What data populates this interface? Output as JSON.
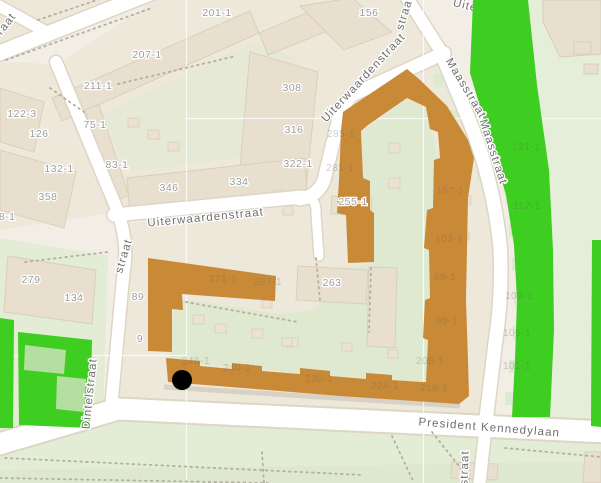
{
  "map": {
    "marker": {
      "x": 182,
      "y": 380,
      "r": 10
    },
    "colors": {
      "base": "#f2eee5",
      "block": "#eee8db",
      "building": "#e8dfce",
      "buildingStroke": "#d8cdb9",
      "road": "#ffffff",
      "casing": "#ddd6c5",
      "parkLight": "#e3ecd4",
      "lawn": "#e4eed8",
      "courtyard": "#dee9d0",
      "highlight": "#c98a38",
      "parcel": "#3ecd21",
      "parcelInner": "#b5dfa2",
      "shed": "#ebe2d1",
      "gardenSquare": "#dcead0",
      "dots": "#b3afa1",
      "houseLabel": "#9c9c9c",
      "streetLabel": "#6e6e6e",
      "ghostLabel": "rgba(100,95,85,0.30)",
      "marker": "#000000",
      "seam": "rgba(255,255,255,0.75)"
    },
    "street_labels": [
      {
        "text": "Uiterwaardenstraat",
        "x": 206,
        "y": 221,
        "rot": -5.5,
        "fs": 12,
        "ls": 1.6
      },
      {
        "text": "Uiterwaardenstraat",
        "x": 366,
        "y": 80,
        "rot": -47,
        "fs": 11,
        "ls": 0.2
      },
      {
        "text": "straat",
        "x": 408,
        "y": 14,
        "rot": -73,
        "fs": 11.5,
        "ls": 1
      },
      {
        "text": "Maasstraat",
        "x": 463,
        "y": 90,
        "rot": 59,
        "fs": 11.5,
        "ls": 1.2
      },
      {
        "text": "Maasstraat",
        "x": 490,
        "y": 153,
        "rot": 72,
        "fs": 11.5,
        "ls": 1.2
      },
      {
        "text": "Dintelstraat",
        "x": 93,
        "y": 394,
        "rot": -84,
        "fs": 11.5,
        "ls": 1.2
      },
      {
        "text": "straat",
        "x": 127,
        "y": 257,
        "rot": -73,
        "fs": 11.5,
        "ls": 1.2
      },
      {
        "text": "President Kennedylaan",
        "x": 489,
        "y": 431,
        "rot": 4.5,
        "fs": 11.5,
        "ls": 0.6
      },
      {
        "text": "straat",
        "x": 468,
        "y": 468,
        "rot": -88,
        "fs": 11.5,
        "ls": 1
      },
      {
        "text": "raat",
        "x": 9,
        "y": 26,
        "rot": -52,
        "fs": 11.5,
        "ls": 1
      }
    ],
    "street_labels_under_overlay": [
      {
        "text": "Uiterwaar",
        "x": 481,
        "y": 13,
        "rot": 14,
        "fs": 11.5,
        "ls": 1
      }
    ],
    "house_numbers": [
      {
        "text": "201-1",
        "x": 217,
        "y": 16
      },
      {
        "text": "156",
        "x": 369,
        "y": 16
      },
      {
        "text": "207-1",
        "x": 147,
        "y": 58
      },
      {
        "text": "211-1",
        "x": 98,
        "y": 89
      },
      {
        "text": "308",
        "x": 292,
        "y": 91
      },
      {
        "text": "122-3",
        "x": 22,
        "y": 117
      },
      {
        "text": "75-1",
        "x": 95,
        "y": 128
      },
      {
        "text": "126",
        "x": 39,
        "y": 137
      },
      {
        "text": "316",
        "x": 294,
        "y": 133
      },
      {
        "text": "83-1",
        "x": 117,
        "y": 168
      },
      {
        "text": "132-1",
        "x": 59,
        "y": 172
      },
      {
        "text": "322-1",
        "x": 298,
        "y": 167
      },
      {
        "text": "334",
        "x": 239,
        "y": 185
      },
      {
        "text": "346",
        "x": 169,
        "y": 191
      },
      {
        "text": "358",
        "x": 48,
        "y": 200
      },
      {
        "text": "58-1",
        "x": 4,
        "y": 220
      },
      {
        "text": "255-1",
        "x": 353,
        "y": 205
      },
      {
        "text": "279",
        "x": 31,
        "y": 283
      },
      {
        "text": "263",
        "x": 332,
        "y": 286
      },
      {
        "text": "134",
        "x": 74,
        "y": 301
      },
      {
        "text": "89",
        "x": 138,
        "y": 300
      },
      {
        "text": "9",
        "x": 140,
        "y": 342
      }
    ],
    "ghost_numbers": [
      {
        "text": "271-1",
        "x": 223,
        "y": 282
      },
      {
        "text": "267-1",
        "x": 268,
        "y": 285
      },
      {
        "text": "285-1",
        "x": 341,
        "y": 137
      },
      {
        "text": "281-1",
        "x": 340,
        "y": 171
      },
      {
        "text": "246-1",
        "x": 196,
        "y": 364
      },
      {
        "text": "240-1",
        "x": 237,
        "y": 371
      },
      {
        "text": "230-1",
        "x": 319,
        "y": 382
      },
      {
        "text": "224-1",
        "x": 385,
        "y": 389
      },
      {
        "text": "216-1",
        "x": 434,
        "y": 391
      },
      {
        "text": "208-1",
        "x": 430,
        "y": 364
      },
      {
        "text": "107-1",
        "x": 450,
        "y": 194
      },
      {
        "text": "103-1",
        "x": 449,
        "y": 242
      },
      {
        "text": "99-1",
        "x": 445,
        "y": 280
      },
      {
        "text": "95-1",
        "x": 447,
        "y": 324
      },
      {
        "text": "121-1",
        "x": 526,
        "y": 150
      },
      {
        "text": "117-1",
        "x": 527,
        "y": 209
      },
      {
        "text": "109-1",
        "x": 519,
        "y": 299
      },
      {
        "text": "105-1",
        "x": 517,
        "y": 336
      },
      {
        "text": "101-1",
        "x": 517,
        "y": 369
      }
    ]
  }
}
